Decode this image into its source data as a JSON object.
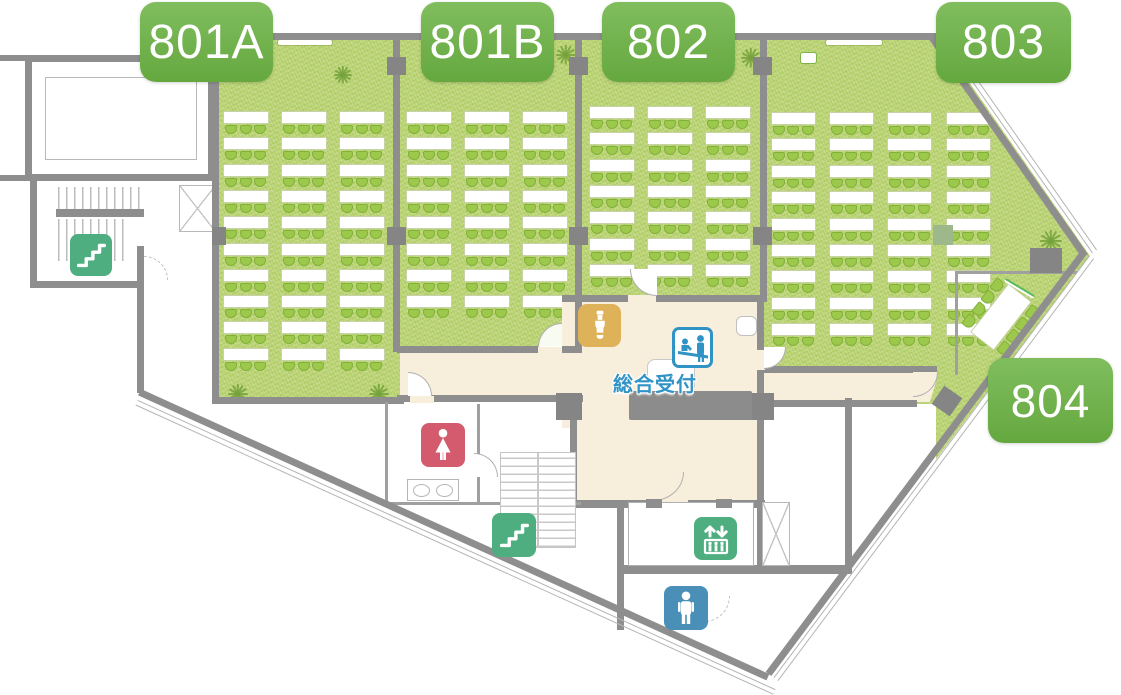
{
  "floor_plan": {
    "kind": "conference-floor-map",
    "rooms": [
      {
        "id": "801A",
        "label": "801A"
      },
      {
        "id": "801B",
        "label": "801B"
      },
      {
        "id": "802",
        "label": "802"
      },
      {
        "id": "803",
        "label": "803"
      },
      {
        "id": "804",
        "label": "804"
      }
    ],
    "reception": {
      "label": "総合受付"
    },
    "icons": [
      {
        "name": "stairs-icon",
        "location": "upper-left-stairwell",
        "color": "#4fae80"
      },
      {
        "name": "stairs-icon",
        "location": "central-stairwell",
        "color": "#4fae80"
      },
      {
        "name": "elevator-icon",
        "color": "#4fae80"
      },
      {
        "name": "womens-restroom-icon",
        "color": "#d45a6e"
      },
      {
        "name": "mens-restroom-icon",
        "color": "#4a8fb8"
      },
      {
        "name": "reception-desk-icon",
        "color": "#2f93c5"
      },
      {
        "name": "vending-machine-icon",
        "color": "#deb259"
      }
    ],
    "colors": {
      "room_label_green": "#72b24e",
      "carpet_green": "#b8d26e",
      "chair_green": "#9cc84c",
      "wall_gray": "#8e8e8e",
      "corridor_beige": "#f8eedc",
      "stairs_elevator_green": "#4fae80",
      "womens_red": "#d45a6e",
      "mens_blue": "#4a8fb8",
      "reception_blue": "#2f93c5",
      "vending_tan": "#deb259",
      "bench_green": "#a4cc66",
      "bench_tan": "#d9b76a",
      "desk_gray": "#8c8c8c"
    }
  },
  "furniture": {
    "classrooms": [
      {
        "room": "801A",
        "cols": [
          223,
          281,
          339
        ],
        "table_w": 46,
        "rows": 10,
        "y0": 111,
        "pitch": 26.3
      },
      {
        "room": "801B",
        "cols": [
          406,
          464,
          522
        ],
        "table_w": 46,
        "rows": 8,
        "y0": 111,
        "pitch": 26.3
      },
      {
        "room": "802",
        "cols": [
          589,
          647,
          705
        ],
        "table_w": 46,
        "rows": 7,
        "y0": 106,
        "pitch": 26.3
      },
      {
        "room": "803",
        "cols": [
          771,
          829,
          887,
          946
        ],
        "table_w": 45,
        "rows": 9,
        "y0": 112,
        "pitch": 26.4
      }
    ],
    "chairs_per_table": 3,
    "meeting_table_804": {
      "cx": 1001,
      "cy": 317,
      "w": 62,
      "h": 30,
      "angle": -52,
      "chairs_per_side": 4,
      "chair_w": 13,
      "chair_h": 11,
      "side_offset": 22,
      "spacing": 15
    },
    "benches": [
      {
        "x": 669,
        "y": 315,
        "colors": [
          "#a4cc66",
          "#d9b76a",
          "#a4cc66"
        ]
      },
      {
        "x": 771,
        "y": 388,
        "colors": [
          "#a4cc66",
          "#d9b76a",
          "#a4cc66"
        ]
      }
    ],
    "plants": [
      {
        "x": 334,
        "y": 66,
        "s": 18
      },
      {
        "x": 556,
        "y": 45,
        "s": 20
      },
      {
        "x": 741,
        "y": 48,
        "s": 20
      },
      {
        "x": 1040,
        "y": 230,
        "s": 22
      },
      {
        "x": 228,
        "y": 384,
        "s": 20
      },
      {
        "x": 369,
        "y": 384,
        "s": 20
      },
      {
        "x": 717,
        "y": 317,
        "s": 20
      },
      {
        "x": 630,
        "y": 359,
        "s": 13
      }
    ],
    "screens": [
      {
        "x": 278,
        "y": 40,
        "w": 54
      },
      {
        "x": 826,
        "y": 40,
        "w": 56
      }
    ],
    "podiums": [
      {
        "x": 428,
        "y": 56,
        "w": 17,
        "h": 13,
        "fill": "#8cbf4e",
        "border": "#ffffff"
      },
      {
        "x": 800,
        "y": 52,
        "w": 17,
        "h": 12,
        "fill": "#ffffff",
        "border": "#7cb342"
      }
    ]
  }
}
